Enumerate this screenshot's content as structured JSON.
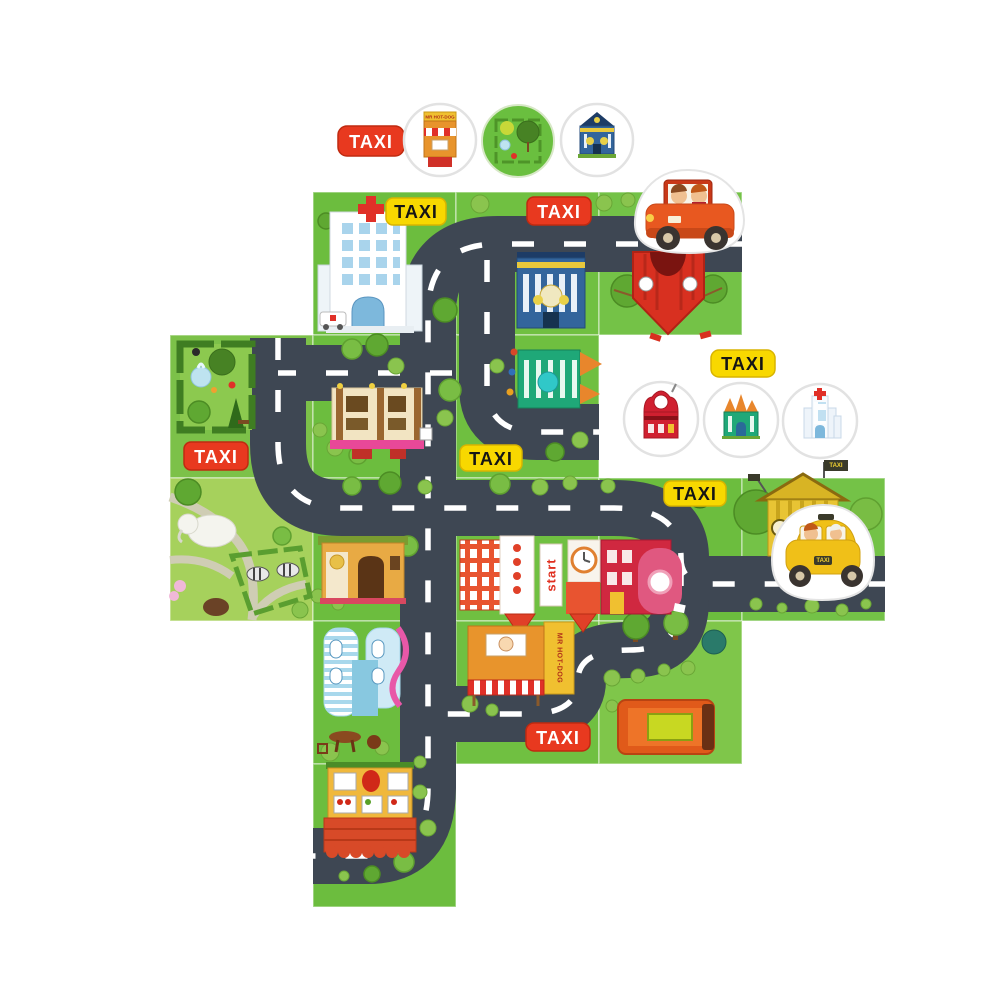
{
  "page": {
    "background": "#ffffff",
    "description": "taxi puzzle board game photo"
  },
  "palette": {
    "road": "#3e4753",
    "road_line": "#ffffff",
    "tile_green": "#6cbd3e",
    "tile_green_light": "#a6d15c",
    "tile_park": "#7cc149",
    "taxi_red": "#e8391f",
    "taxi_yellow": "#f8d800",
    "token_ring": "#e2e2e2",
    "red_car": "#e8571e",
    "yellow_taxi": "#f2c413"
  },
  "taxi_signs": [
    {
      "text": "TAXI",
      "style": "red",
      "location": "top-left loose sign"
    },
    {
      "text": "TAXI",
      "style": "yellow",
      "location": "hospital tile"
    },
    {
      "text": "TAXI",
      "style": "red",
      "location": "school tile top"
    },
    {
      "text": "TAXI",
      "style": "red",
      "location": "park maze tile"
    },
    {
      "text": "TAXI",
      "style": "yellow",
      "location": "center tile"
    },
    {
      "text": "TAXI",
      "style": "yellow",
      "location": "right loose sign"
    },
    {
      "text": "TAXI",
      "style": "yellow",
      "location": "red-house tile"
    },
    {
      "text": "TAXI",
      "style": "red",
      "location": "hot-dog tile"
    }
  ],
  "signs": {
    "start_banner": "start",
    "hotdog_stand": "MR HOT-DOG",
    "hotdog_token": "MR HOT-DOG",
    "taxi_plate": "TAXI",
    "depot_flag": "TAXI"
  },
  "tokens": {
    "top_row": [
      {
        "name": "hot-dog-stand-token"
      },
      {
        "name": "park-token"
      },
      {
        "name": "school-token"
      }
    ],
    "right_group": [
      {
        "name": "red-house-token"
      },
      {
        "name": "green-castle-token"
      },
      {
        "name": "hospital-token"
      }
    ]
  },
  "pieces": {
    "red_car": {
      "name": "red-car-piece",
      "passengers": 2
    },
    "yellow_taxi": {
      "name": "yellow-taxi-piece",
      "passengers": 2
    }
  },
  "tiles": [
    {
      "row": 0,
      "col": 1,
      "feature": "hospital"
    },
    {
      "row": 0,
      "col": 2,
      "feature": "blue school + road junction"
    },
    {
      "row": 0,
      "col": 3,
      "feature": "red circus tent"
    },
    {
      "row": 1,
      "col": 0,
      "feature": "park maze with fountain"
    },
    {
      "row": 1,
      "col": 1,
      "feature": "cream hotel"
    },
    {
      "row": 1,
      "col": 2,
      "feature": "green castle house"
    },
    {
      "row": 2,
      "col": 0,
      "feature": "zoo park with elephant and zebras"
    },
    {
      "row": 2,
      "col": 1,
      "feature": "bakery shop"
    },
    {
      "row": 2,
      "col": 2,
      "feature": "start building with clock"
    },
    {
      "row": 2,
      "col": 3,
      "feature": "red town house"
    },
    {
      "row": 2,
      "col": 4,
      "feature": "taxi depot"
    },
    {
      "row": 3,
      "col": 1,
      "feature": "blue laundry cafe"
    },
    {
      "row": 3,
      "col": 2,
      "feature": "hot-dog stand"
    },
    {
      "row": 3,
      "col": 3,
      "feature": "orange van on grass"
    },
    {
      "row": 4,
      "col": 1,
      "feature": "fruit shop with red awning"
    }
  ]
}
